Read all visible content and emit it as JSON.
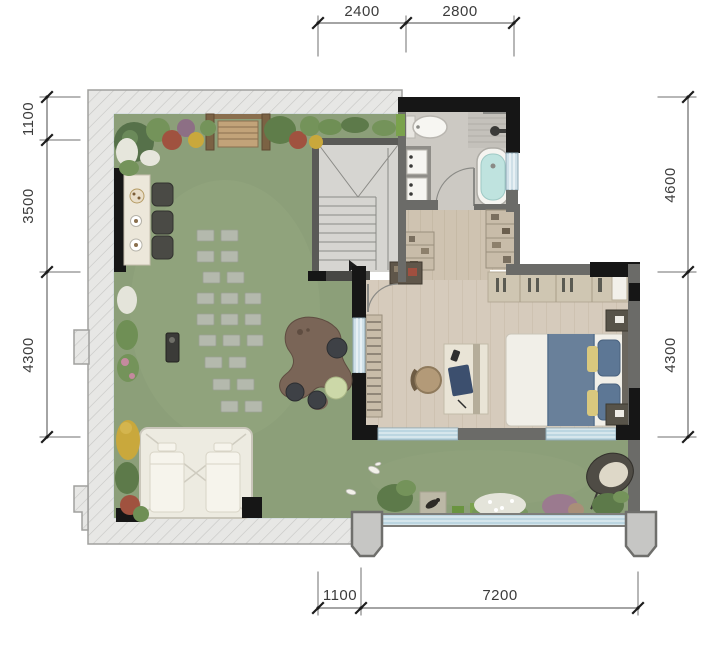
{
  "page": {
    "type": "architectural floor plan with roof terrace",
    "background": "#ffffff"
  },
  "dimensions": {
    "top": [
      "2400",
      "2800"
    ],
    "left": [
      "1100",
      "3500",
      "4300"
    ],
    "right": [
      "4600",
      "4300"
    ],
    "bottom": [
      "1100",
      "7200"
    ]
  },
  "colors": {
    "lawn_green": "#8c9f79",
    "roof_overhang": "#e7e7e5",
    "wall_black": "#161616",
    "wall_gray": "#6b6b68",
    "wood_floor": "#d6cbbc",
    "tile_floor": "#ccc9c3",
    "bath_water": "#bfe3df",
    "glazing_blue": "#bcd6e1",
    "dimension_line": "#4a4a4a",
    "bed_runner": "#69809a",
    "tent_white": "#edebe1"
  }
}
